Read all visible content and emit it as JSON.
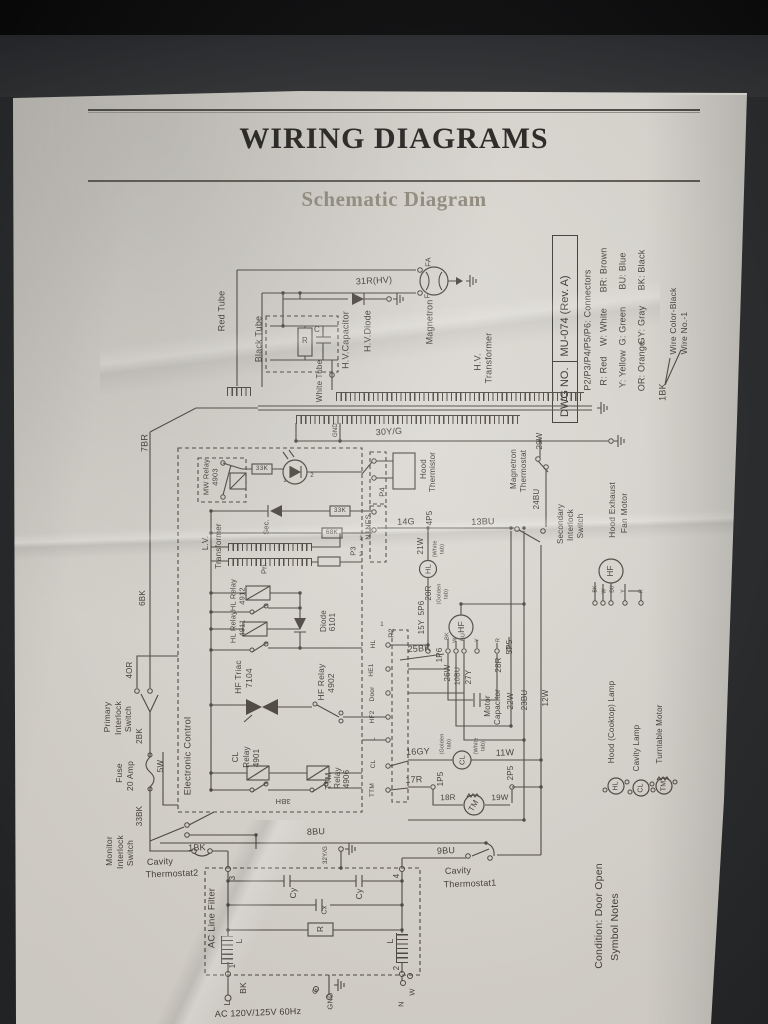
{
  "page": {
    "title": "WIRING DIAGRAMS",
    "subtitle": "Schematic Diagram"
  },
  "drawing": {
    "label": "DWG NO.",
    "number": "MU-074 (Rev. A)"
  },
  "labels": [
    {
      "t": "P2/P3/P4/P5/P6: Connectors",
      "x": 588,
      "y": 330,
      "r": -90,
      "s": 9,
      "n": "connectors-note"
    },
    {
      "t": "R: Red",
      "x": 604,
      "y": 371,
      "r": -90,
      "s": 9
    },
    {
      "t": "W: White",
      "x": 604,
      "y": 327,
      "r": -90,
      "s": 9
    },
    {
      "t": "BR: Brown",
      "x": 604,
      "y": 270,
      "r": -90,
      "s": 9
    },
    {
      "t": "Y: Yellow",
      "x": 623,
      "y": 369,
      "r": -90,
      "s": 9
    },
    {
      "t": "G: Green",
      "x": 623,
      "y": 326,
      "r": -90,
      "s": 9
    },
    {
      "t": "BU: Blue",
      "x": 623,
      "y": 271,
      "r": -90,
      "s": 9
    },
    {
      "t": "OR: Orange",
      "x": 642,
      "y": 366,
      "r": -90,
      "s": 9
    },
    {
      "t": "GY: Gray",
      "x": 642,
      "y": 325,
      "r": -90,
      "s": 9
    },
    {
      "t": "BK: Black",
      "x": 642,
      "y": 270,
      "r": -90,
      "s": 9
    },
    {
      "t": "1BK",
      "x": 663,
      "y": 392,
      "r": -90,
      "s": 9,
      "n": "wire-example-code"
    },
    {
      "t": "Wire Color-Black",
      "x": 673,
      "y": 321,
      "r": -90,
      "s": 8.5,
      "n": "wire-example-color"
    },
    {
      "t": "Wire No.-1",
      "x": 684,
      "y": 333,
      "r": -90,
      "s": 8.5,
      "n": "wire-example-number"
    },
    {
      "t": "Red Tube",
      "x": 222,
      "y": 311,
      "r": -90,
      "s": 9,
      "n": "red-tube-label"
    },
    {
      "t": "Black Tube",
      "x": 259,
      "y": 339,
      "r": -90,
      "s": 9,
      "n": "black-tube-label"
    },
    {
      "t": "White Tube",
      "x": 320,
      "y": 381,
      "r": -90,
      "s": 8,
      "n": "white-tube-label"
    },
    {
      "t": "31R(HV)",
      "x": 374,
      "y": 281,
      "r": -3,
      "s": 9
    },
    {
      "t": "FA",
      "x": 428,
      "y": 262,
      "r": -90,
      "s": 7.5
    },
    {
      "t": "F",
      "x": 427,
      "y": 296,
      "r": -90,
      "s": 7.5
    },
    {
      "t": "Magnetron",
      "x": 430,
      "y": 322,
      "r": -90,
      "s": 9,
      "n": "magnetron-label"
    },
    {
      "t": "R",
      "x": 305,
      "y": 341,
      "r": 0,
      "s": 8
    },
    {
      "t": "C",
      "x": 317,
      "y": 330,
      "r": 0,
      "s": 8
    },
    {
      "t": "H.V.Capacitor",
      "x": 346,
      "y": 340,
      "r": -90,
      "s": 9,
      "n": "hv-capacitor-label"
    },
    {
      "t": "H.V.Diode",
      "x": 368,
      "y": 331,
      "r": -90,
      "s": 9,
      "n": "hv-diode-label"
    },
    {
      "t": "H.V.",
      "x": 478,
      "y": 362,
      "r": -90,
      "s": 9,
      "n": "hv-transformer-label"
    },
    {
      "t": "Transformer",
      "x": 489,
      "y": 358,
      "r": -90,
      "s": 9
    },
    {
      "t": "GND",
      "x": 336,
      "y": 430,
      "r": -90,
      "s": 6
    },
    {
      "t": "30Y/G",
      "x": 389,
      "y": 432,
      "r": -3,
      "s": 9
    },
    {
      "t": "7BR",
      "x": 145,
      "y": 443,
      "r": -90,
      "s": 9
    },
    {
      "t": "MW Relay",
      "x": 206,
      "y": 477,
      "r": -90,
      "s": 7.5,
      "n": "mw-relay-label"
    },
    {
      "t": "4903",
      "x": 215,
      "y": 477,
      "r": -90,
      "s": 7.5
    },
    {
      "t": "33K",
      "x": 262,
      "y": 469,
      "r": 0,
      "s": 6.5
    },
    {
      "t": "1",
      "x": 285,
      "y": 481,
      "r": 0,
      "s": 6
    },
    {
      "t": "2",
      "x": 312,
      "y": 476,
      "r": 0,
      "s": 6
    },
    {
      "t": "33K",
      "x": 340,
      "y": 511,
      "r": 0,
      "s": 6.5
    },
    {
      "t": "68K",
      "x": 332,
      "y": 533,
      "r": 0,
      "s": 6.5
    },
    {
      "t": "Sec.",
      "x": 266,
      "y": 527,
      "r": -90,
      "s": 7.5
    },
    {
      "t": "L.V.",
      "x": 206,
      "y": 543,
      "r": -90,
      "s": 8,
      "n": "lv-transformer-label"
    },
    {
      "t": "Transformer",
      "x": 219,
      "y": 546,
      "r": -90,
      "s": 8
    },
    {
      "t": "Pri.",
      "x": 264,
      "y": 568,
      "r": -90,
      "s": 7.5
    },
    {
      "t": "HL Relay",
      "x": 233,
      "y": 595,
      "r": -90,
      "s": 7.5,
      "n": "hl-relay-4912-label"
    },
    {
      "t": "4912",
      "x": 242,
      "y": 596,
      "r": -90,
      "s": 7.5
    },
    {
      "t": "HL Relay",
      "x": 233,
      "y": 627,
      "r": -90,
      "s": 7.5,
      "n": "hl-relay-4911-label"
    },
    {
      "t": "4911",
      "x": 242,
      "y": 628,
      "r": -90,
      "s": 7.5
    },
    {
      "t": "Diode",
      "x": 324,
      "y": 621,
      "r": -90,
      "s": 8,
      "n": "diode-6101-label"
    },
    {
      "t": "6101",
      "x": 333,
      "y": 622,
      "r": -90,
      "s": 8
    },
    {
      "t": "HF Triac",
      "x": 238,
      "y": 677,
      "r": -90,
      "s": 8.5,
      "n": "hf-triac-label"
    },
    {
      "t": "7104",
      "x": 249,
      "y": 678,
      "r": -90,
      "s": 8.5
    },
    {
      "t": "HF Relay",
      "x": 321,
      "y": 682,
      "r": -90,
      "s": 8.5,
      "n": "hf-relay-label"
    },
    {
      "t": "4902",
      "x": 331,
      "y": 683,
      "r": -90,
      "s": 8.5
    },
    {
      "t": "CL",
      "x": 236,
      "y": 757,
      "r": -90,
      "s": 8,
      "n": "cl-relay-label"
    },
    {
      "t": "Relay",
      "x": 247,
      "y": 757,
      "r": -90,
      "s": 8
    },
    {
      "t": "4901",
      "x": 257,
      "y": 758,
      "r": -90,
      "s": 8
    },
    {
      "t": "TTM",
      "x": 329,
      "y": 781,
      "r": -90,
      "s": 8,
      "n": "ttm-relay-label"
    },
    {
      "t": "Relay",
      "x": 338,
      "y": 778,
      "r": -90,
      "s": 8
    },
    {
      "t": "4906",
      "x": 347,
      "y": 779,
      "r": -90,
      "s": 8
    },
    {
      "t": "Electronic Control",
      "x": 188,
      "y": 756,
      "r": -90,
      "s": 9.5,
      "n": "electronic-control-label"
    },
    {
      "t": "3BH",
      "x": 283,
      "y": 801,
      "r": 180,
      "s": 7.5
    },
    {
      "t": "HL",
      "x": 374,
      "y": 644,
      "r": -90,
      "s": 6.5
    },
    {
      "t": "HE1",
      "x": 372,
      "y": 670,
      "r": -90,
      "s": 6.5
    },
    {
      "t": "Door",
      "x": 373,
      "y": 694,
      "r": -90,
      "s": 6.5
    },
    {
      "t": "HF2",
      "x": 373,
      "y": 717,
      "r": -90,
      "s": 6.5
    },
    {
      "t": "L",
      "x": 374,
      "y": 739,
      "r": -90,
      "s": 6.5
    },
    {
      "t": "CL",
      "x": 374,
      "y": 764,
      "r": -90,
      "s": 6.5
    },
    {
      "t": "TTM",
      "x": 373,
      "y": 790,
      "r": -90,
      "s": 6.5
    },
    {
      "t": "1",
      "x": 382,
      "y": 625,
      "r": 0,
      "s": 6
    },
    {
      "t": "P2",
      "x": 391,
      "y": 633,
      "r": -90,
      "s": 7.5,
      "n": "p2-connector-label"
    },
    {
      "t": "N1NFS",
      "x": 368,
      "y": 527,
      "r": -90,
      "s": 7.5
    },
    {
      "t": "P3",
      "x": 353,
      "y": 551,
      "r": -90,
      "s": 7.5,
      "n": "p3-connector-label"
    },
    {
      "t": "1",
      "x": 361,
      "y": 539,
      "r": 0,
      "s": 6
    },
    {
      "t": "2",
      "x": 361,
      "y": 555,
      "r": 0,
      "s": 6
    },
    {
      "t": "P4",
      "x": 382,
      "y": 492,
      "r": -90,
      "s": 7.5,
      "n": "p4-connector-label"
    },
    {
      "t": "Hood",
      "x": 424,
      "y": 469,
      "r": -90,
      "s": 8,
      "n": "hood-thermistor-label"
    },
    {
      "t": "Thermistor",
      "x": 433,
      "y": 472,
      "r": -90,
      "s": 8
    },
    {
      "t": "14G",
      "x": 406,
      "y": 522,
      "r": -2,
      "s": 9
    },
    {
      "t": "4P5",
      "x": 430,
      "y": 518,
      "r": -90,
      "s": 8
    },
    {
      "t": "13BU",
      "x": 483,
      "y": 522,
      "r": -2,
      "s": 9
    },
    {
      "t": "21W",
      "x": 421,
      "y": 546,
      "r": -90,
      "s": 8
    },
    {
      "t": "(White",
      "x": 436,
      "y": 549,
      "r": -90,
      "s": 5.5
    },
    {
      "t": "tab)",
      "x": 443,
      "y": 549,
      "r": -90,
      "s": 5.5
    },
    {
      "t": "HL",
      "x": 428,
      "y": 569,
      "r": -90,
      "s": 7.5
    },
    {
      "t": "20R",
      "x": 429,
      "y": 593,
      "r": -90,
      "s": 8
    },
    {
      "t": "(Golden",
      "x": 440,
      "y": 594,
      "r": -90,
      "s": 5.5
    },
    {
      "t": "tab)",
      "x": 447,
      "y": 594,
      "r": -90,
      "s": 5.5
    },
    {
      "t": "5P6",
      "x": 422,
      "y": 608,
      "r": -90,
      "s": 8
    },
    {
      "t": "15Y",
      "x": 422,
      "y": 627,
      "r": -90,
      "s": 8
    },
    {
      "t": "Magnetron",
      "x": 514,
      "y": 469,
      "r": -90,
      "s": 8,
      "n": "magnetron-thermostat-label"
    },
    {
      "t": "Thermostat",
      "x": 524,
      "y": 471,
      "r": -90,
      "s": 8
    },
    {
      "t": "29W",
      "x": 540,
      "y": 441,
      "r": -90,
      "s": 8
    },
    {
      "t": "24BU",
      "x": 537,
      "y": 499,
      "r": -90,
      "s": 8
    },
    {
      "t": "Secondary",
      "x": 561,
      "y": 524,
      "r": -90,
      "s": 8,
      "n": "secondary-interlock-label"
    },
    {
      "t": "Interlock",
      "x": 571,
      "y": 525,
      "r": -90,
      "s": 8
    },
    {
      "t": "Switch",
      "x": 581,
      "y": 526,
      "r": -90,
      "s": 8
    },
    {
      "t": "Hood Exhaust",
      "x": 612,
      "y": 510,
      "r": -90,
      "s": 8.5,
      "n": "hood-exhaust-fan-label"
    },
    {
      "t": "Fan Motor",
      "x": 624,
      "y": 513,
      "r": -90,
      "s": 8.5
    },
    {
      "t": "HF",
      "x": 611,
      "y": 571,
      "r": -90,
      "s": 8
    },
    {
      "t": "BK",
      "x": 596,
      "y": 589,
      "r": -90,
      "s": 5
    },
    {
      "t": "W",
      "x": 605,
      "y": 591,
      "r": -90,
      "s": 5
    },
    {
      "t": "BU",
      "x": 613,
      "y": 589,
      "r": -90,
      "s": 5
    },
    {
      "t": "Y",
      "x": 624,
      "y": 591,
      "r": -90,
      "s": 5
    },
    {
      "t": "R",
      "x": 642,
      "y": 591,
      "r": -90,
      "s": 5
    },
    {
      "t": "HF",
      "x": 461,
      "y": 627,
      "r": -90,
      "s": 8.5
    },
    {
      "t": "BK",
      "x": 448,
      "y": 636,
      "r": -90,
      "s": 5.5
    },
    {
      "t": "W",
      "x": 456,
      "y": 640,
      "r": -90,
      "s": 5.5
    },
    {
      "t": "BU",
      "x": 464,
      "y": 637,
      "r": -90,
      "s": 5.5
    },
    {
      "t": "Y",
      "x": 478,
      "y": 640,
      "r": -90,
      "s": 5.5
    },
    {
      "t": "R",
      "x": 499,
      "y": 640,
      "r": -90,
      "s": 5.5
    },
    {
      "t": "1P6",
      "x": 440,
      "y": 655,
      "r": -90,
      "s": 8
    },
    {
      "t": "5P5",
      "x": 510,
      "y": 647,
      "r": -90,
      "s": 8
    },
    {
      "t": "25BK",
      "x": 419,
      "y": 649,
      "r": -3,
      "s": 9
    },
    {
      "t": "26W",
      "x": 448,
      "y": 673,
      "r": -90,
      "s": 8
    },
    {
      "t": "10BU",
      "x": 458,
      "y": 676,
      "r": -90,
      "s": 7
    },
    {
      "t": "27Y",
      "x": 469,
      "y": 677,
      "r": -90,
      "s": 8
    },
    {
      "t": "28R",
      "x": 499,
      "y": 665,
      "r": -90,
      "s": 8
    },
    {
      "t": "Motor",
      "x": 488,
      "y": 706,
      "r": -90,
      "s": 8,
      "n": "motor-capacitor-label"
    },
    {
      "t": "Capacitor",
      "x": 498,
      "y": 707,
      "r": -90,
      "s": 8
    },
    {
      "t": "22W",
      "x": 511,
      "y": 701,
      "r": -90,
      "s": 8
    },
    {
      "t": "23BU",
      "x": 525,
      "y": 700,
      "r": -90,
      "s": 8
    },
    {
      "t": "12W",
      "x": 546,
      "y": 698,
      "r": -90,
      "s": 8
    },
    {
      "t": "16GY",
      "x": 418,
      "y": 752,
      "r": -2,
      "s": 9
    },
    {
      "t": "(Golden",
      "x": 443,
      "y": 744,
      "r": -90,
      "s": 5.5
    },
    {
      "t": "tab)",
      "x": 450,
      "y": 744,
      "r": -90,
      "s": 5.5
    },
    {
      "t": "CL",
      "x": 462,
      "y": 760,
      "r": -90,
      "s": 7.5
    },
    {
      "t": "(White",
      "x": 477,
      "y": 746,
      "r": -90,
      "s": 5.5
    },
    {
      "t": "tab)",
      "x": 484,
      "y": 746,
      "r": -90,
      "s": 5.5
    },
    {
      "t": "11W",
      "x": 505,
      "y": 753,
      "r": -2,
      "s": 9
    },
    {
      "t": "17R",
      "x": 414,
      "y": 780,
      "r": -2,
      "s": 9
    },
    {
      "t": "1P5",
      "x": 441,
      "y": 779,
      "r": -90,
      "s": 8
    },
    {
      "t": "2P5",
      "x": 511,
      "y": 773,
      "r": -90,
      "s": 8
    },
    {
      "t": "18R",
      "x": 448,
      "y": 798,
      "r": -2,
      "s": 8
    },
    {
      "t": "TM",
      "x": 474,
      "y": 806,
      "r": -60,
      "s": 8
    },
    {
      "t": "19W",
      "x": 500,
      "y": 798,
      "r": -2,
      "s": 8
    },
    {
      "t": "6BK",
      "x": 143,
      "y": 598,
      "r": -90,
      "s": 8
    },
    {
      "t": "4OR",
      "x": 130,
      "y": 670,
      "r": -90,
      "s": 8
    },
    {
      "t": "Primary",
      "x": 107,
      "y": 717,
      "r": -90,
      "s": 8.5,
      "n": "primary-interlock-label"
    },
    {
      "t": "Interlock",
      "x": 118,
      "y": 718,
      "r": -90,
      "s": 8.5
    },
    {
      "t": "Switch",
      "x": 128,
      "y": 719,
      "r": -90,
      "s": 8.5
    },
    {
      "t": "2BK",
      "x": 140,
      "y": 736,
      "r": -90,
      "s": 8
    },
    {
      "t": "5W",
      "x": 161,
      "y": 766,
      "r": -90,
      "s": 8
    },
    {
      "t": "Fuse",
      "x": 119,
      "y": 773,
      "r": -90,
      "s": 8.5,
      "n": "fuse-label"
    },
    {
      "t": "20 Amp",
      "x": 130,
      "y": 776,
      "r": -90,
      "s": 8.5
    },
    {
      "t": "33BK",
      "x": 140,
      "y": 816,
      "r": -90,
      "s": 8
    },
    {
      "t": "Monitor",
      "x": 109,
      "y": 851,
      "r": -90,
      "s": 8.5,
      "n": "monitor-interlock-label"
    },
    {
      "t": "Interlock",
      "x": 120,
      "y": 852,
      "r": -90,
      "s": 8.5
    },
    {
      "t": "Switch",
      "x": 130,
      "y": 853,
      "r": -90,
      "s": 8.5
    },
    {
      "t": "1BK",
      "x": 197,
      "y": 848,
      "r": -2,
      "s": 9
    },
    {
      "t": "8BU",
      "x": 316,
      "y": 832,
      "r": -2,
      "s": 9
    },
    {
      "t": "Cavity",
      "x": 160,
      "y": 862,
      "r": -2,
      "s": 9,
      "n": "cavity-thermostat2-label"
    },
    {
      "t": "Thermostat2",
      "x": 172,
      "y": 874,
      "r": -2,
      "s": 9
    },
    {
      "t": "32Y/G",
      "x": 326,
      "y": 855,
      "r": -90,
      "s": 6
    },
    {
      "t": "9BU",
      "x": 446,
      "y": 851,
      "r": -2,
      "s": 9
    },
    {
      "t": "Cavity",
      "x": 458,
      "y": 871,
      "r": -2,
      "s": 9,
      "n": "cavity-thermostat1-label"
    },
    {
      "t": "Thermostat1",
      "x": 470,
      "y": 884,
      "r": -2,
      "s": 9
    },
    {
      "t": "AC Line Filter",
      "x": 212,
      "y": 918,
      "r": -90,
      "s": 9.5,
      "n": "ac-line-filter-label"
    },
    {
      "t": "3",
      "x": 233,
      "y": 878,
      "r": -90,
      "s": 8
    },
    {
      "t": "4",
      "x": 397,
      "y": 876,
      "r": -90,
      "s": 8
    },
    {
      "t": "1",
      "x": 233,
      "y": 966,
      "r": -90,
      "s": 8
    },
    {
      "t": "2",
      "x": 397,
      "y": 968,
      "r": -90,
      "s": 8
    },
    {
      "t": "Cy",
      "x": 293,
      "y": 893,
      "r": -90,
      "s": 8.5
    },
    {
      "t": "Cy",
      "x": 359,
      "y": 894,
      "r": -90,
      "s": 8.5
    },
    {
      "t": "Cx",
      "x": 325,
      "y": 910,
      "r": -90,
      "s": 7
    },
    {
      "t": "R",
      "x": 320,
      "y": 929,
      "r": -90,
      "s": 8.5
    },
    {
      "t": "L",
      "x": 239,
      "y": 941,
      "r": -90,
      "s": 8.5
    },
    {
      "t": "L",
      "x": 390,
      "y": 941,
      "r": -90,
      "s": 8.5
    },
    {
      "t": "BK",
      "x": 243,
      "y": 988,
      "r": -90,
      "s": 8.5
    },
    {
      "t": "L",
      "x": 228,
      "y": 1003,
      "r": -90,
      "s": 8
    },
    {
      "t": "AC 120V/125V 60Hz",
      "x": 258,
      "y": 1013,
      "r": -2,
      "s": 9,
      "n": "power-rating-label"
    },
    {
      "t": "G",
      "x": 315,
      "y": 991,
      "r": -90,
      "s": 7.5
    },
    {
      "t": "GND",
      "x": 330,
      "y": 1001,
      "r": -90,
      "s": 7.5
    },
    {
      "t": "N",
      "x": 401,
      "y": 1004,
      "r": -90,
      "s": 7.5
    },
    {
      "t": "W",
      "x": 412,
      "y": 992,
      "r": -90,
      "s": 7.5
    },
    {
      "t": "Condition: Door Open",
      "x": 599,
      "y": 916,
      "r": -90,
      "s": 10.5,
      "n": "condition-note"
    },
    {
      "t": "Symbol Notes",
      "x": 615,
      "y": 927,
      "r": -90,
      "s": 10.5,
      "n": "symbol-notes-title"
    },
    {
      "t": "HL",
      "x": 616,
      "y": 786,
      "r": -90,
      "s": 7
    },
    {
      "t": "Hood (Cooktop) Lamp",
      "x": 612,
      "y": 722,
      "r": -90,
      "s": 8,
      "n": "hood-lamp-legend"
    },
    {
      "t": "CL",
      "x": 641,
      "y": 788,
      "r": -90,
      "s": 7
    },
    {
      "t": "Cavity Lamp",
      "x": 637,
      "y": 748,
      "r": -90,
      "s": 8,
      "n": "cavity-lamp-legend"
    },
    {
      "t": "TM",
      "x": 664,
      "y": 786,
      "r": -90,
      "s": 7
    },
    {
      "t": "Turntable Motor",
      "x": 660,
      "y": 734,
      "r": -90,
      "s": 8,
      "n": "turntable-motor-legend"
    }
  ]
}
